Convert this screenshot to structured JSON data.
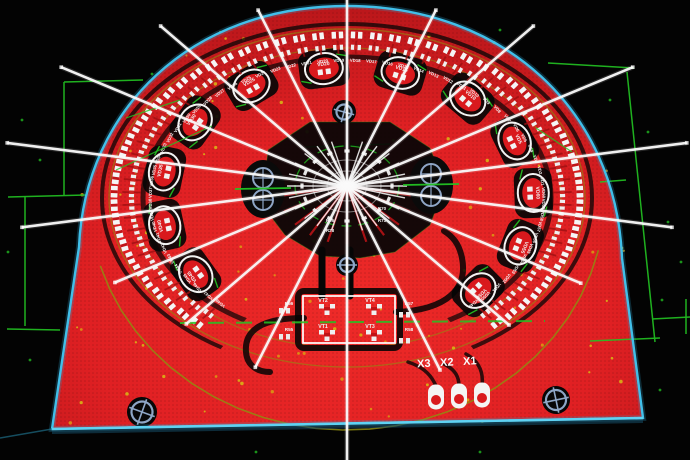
{
  "app": {
    "name": "pcb-cad-viewport"
  },
  "colors": {
    "background": "#030303",
    "board_red": "#d9191d",
    "board_red_bright": "#ee2a28",
    "board_red_dark": "#b01418",
    "outline_cyan": "#41bfe9",
    "grid_green": "#23c423",
    "silk_olive": "#8f8c11",
    "ray_white": "#fafafa",
    "pad_slate": "#8ea6c6",
    "dot_yellow": "#d8c414"
  },
  "ring": {
    "designators": [
      "VD48",
      "VD47",
      "VD46",
      "VD45",
      "VD44",
      "VD43",
      "VD42",
      "VD41",
      "VD40",
      "VD39",
      "VD38",
      "VD37",
      "VD36",
      "VD35",
      "VD34",
      "VD33",
      "VD32",
      "VD31",
      "VD30",
      "VD29",
      "VD28",
      "VD27",
      "VD26",
      "VD25",
      "VD24",
      "VD23",
      "VD22",
      "VD21",
      "VD20",
      "VD19",
      "VD18",
      "VD17",
      "VD16",
      "VD15",
      "VD14",
      "VD13",
      "VD12",
      "VD11",
      "VD10",
      "VD9",
      "VD8",
      "VD7",
      "VD6",
      "VD5",
      "VD4",
      "VD3",
      "VD2",
      "VD1",
      "VD60",
      "VD59",
      "VD58",
      "VD57",
      "VD56",
      "VD55",
      "VD54",
      "VD53",
      "VD52",
      "VD51",
      "VD50",
      "VD49"
    ],
    "circled_labels": [
      "VD45",
      "VD40",
      "VD35",
      "VD30",
      "VD25",
      "VD20",
      "VD15",
      "VD10",
      "VD5",
      "VD60",
      "VD55",
      "VD50"
    ]
  },
  "hub": {
    "left_pad_labels": [
      "R26",
      "R28"
    ],
    "right_pad_labels": [
      "R70",
      "R71"
    ]
  },
  "driver_box": {
    "transistors": [
      "VT2",
      "VT4",
      "VT1",
      "VT3"
    ],
    "resistors_left": [
      "R56",
      "R55"
    ],
    "resistors_right": [
      "R57",
      "R58"
    ]
  },
  "connector": {
    "labels": [
      "X3",
      "X2",
      "X1"
    ]
  }
}
